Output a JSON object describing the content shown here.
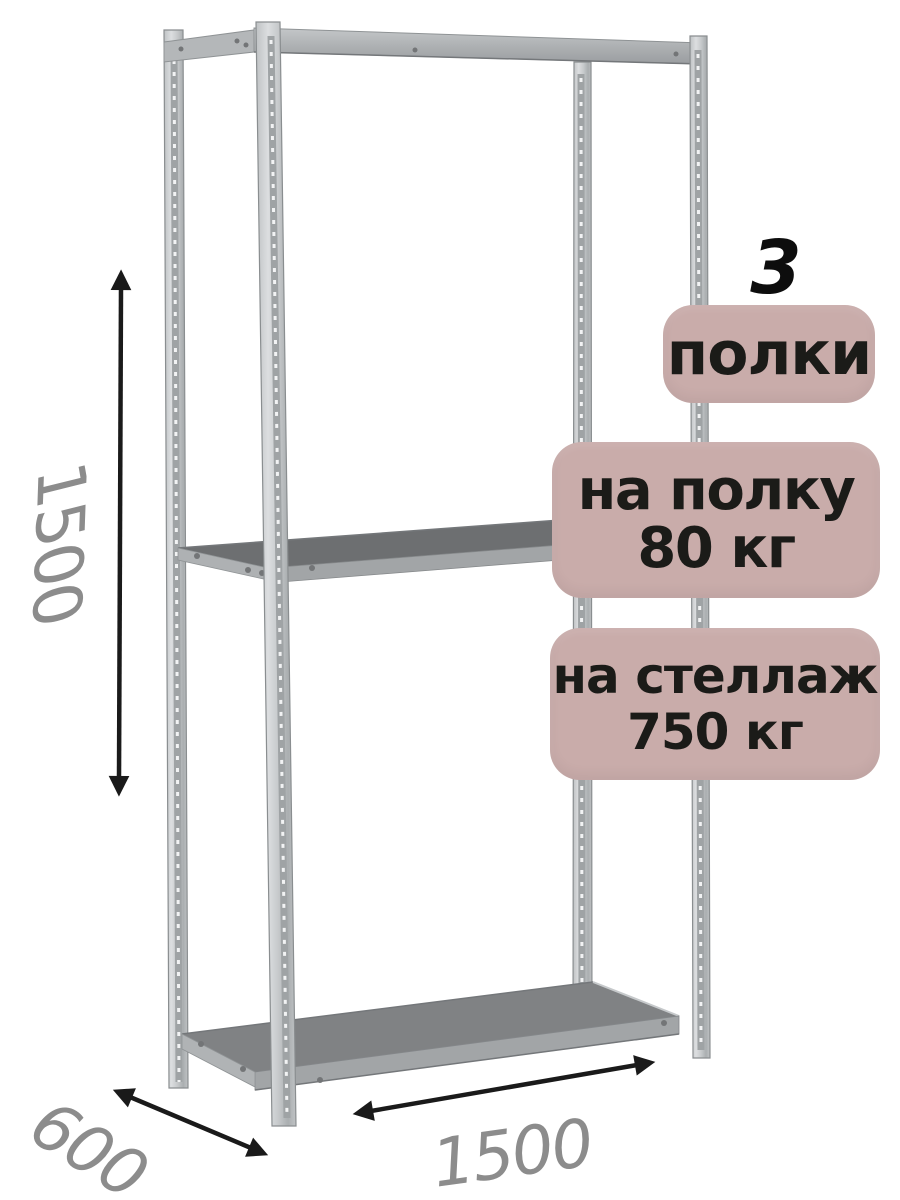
{
  "product": {
    "shelf_count": "3",
    "shelf_count_unit": "полки",
    "shelf_load_title": "на полку",
    "shelf_load_value": "80 кг",
    "rack_load_title": "на стеллаж",
    "rack_load_value": "750 кг"
  },
  "dimensions": {
    "height_mm": "1500",
    "depth_mm": "600",
    "width_mm": "1500"
  },
  "colors": {
    "background": "#ffffff",
    "badge_bg": "#c9acaa",
    "badge_text": "#1b1b18",
    "count_text": "#0d0d0d",
    "dim_text": "#8c8c8c",
    "arrow": "#1a1a1a",
    "metal_edge": "#8a8e90",
    "shelf_top_dark": "#6d6f71",
    "shelf_top_mid": "#808284",
    "shelf_front": "#a2a5a7"
  }
}
